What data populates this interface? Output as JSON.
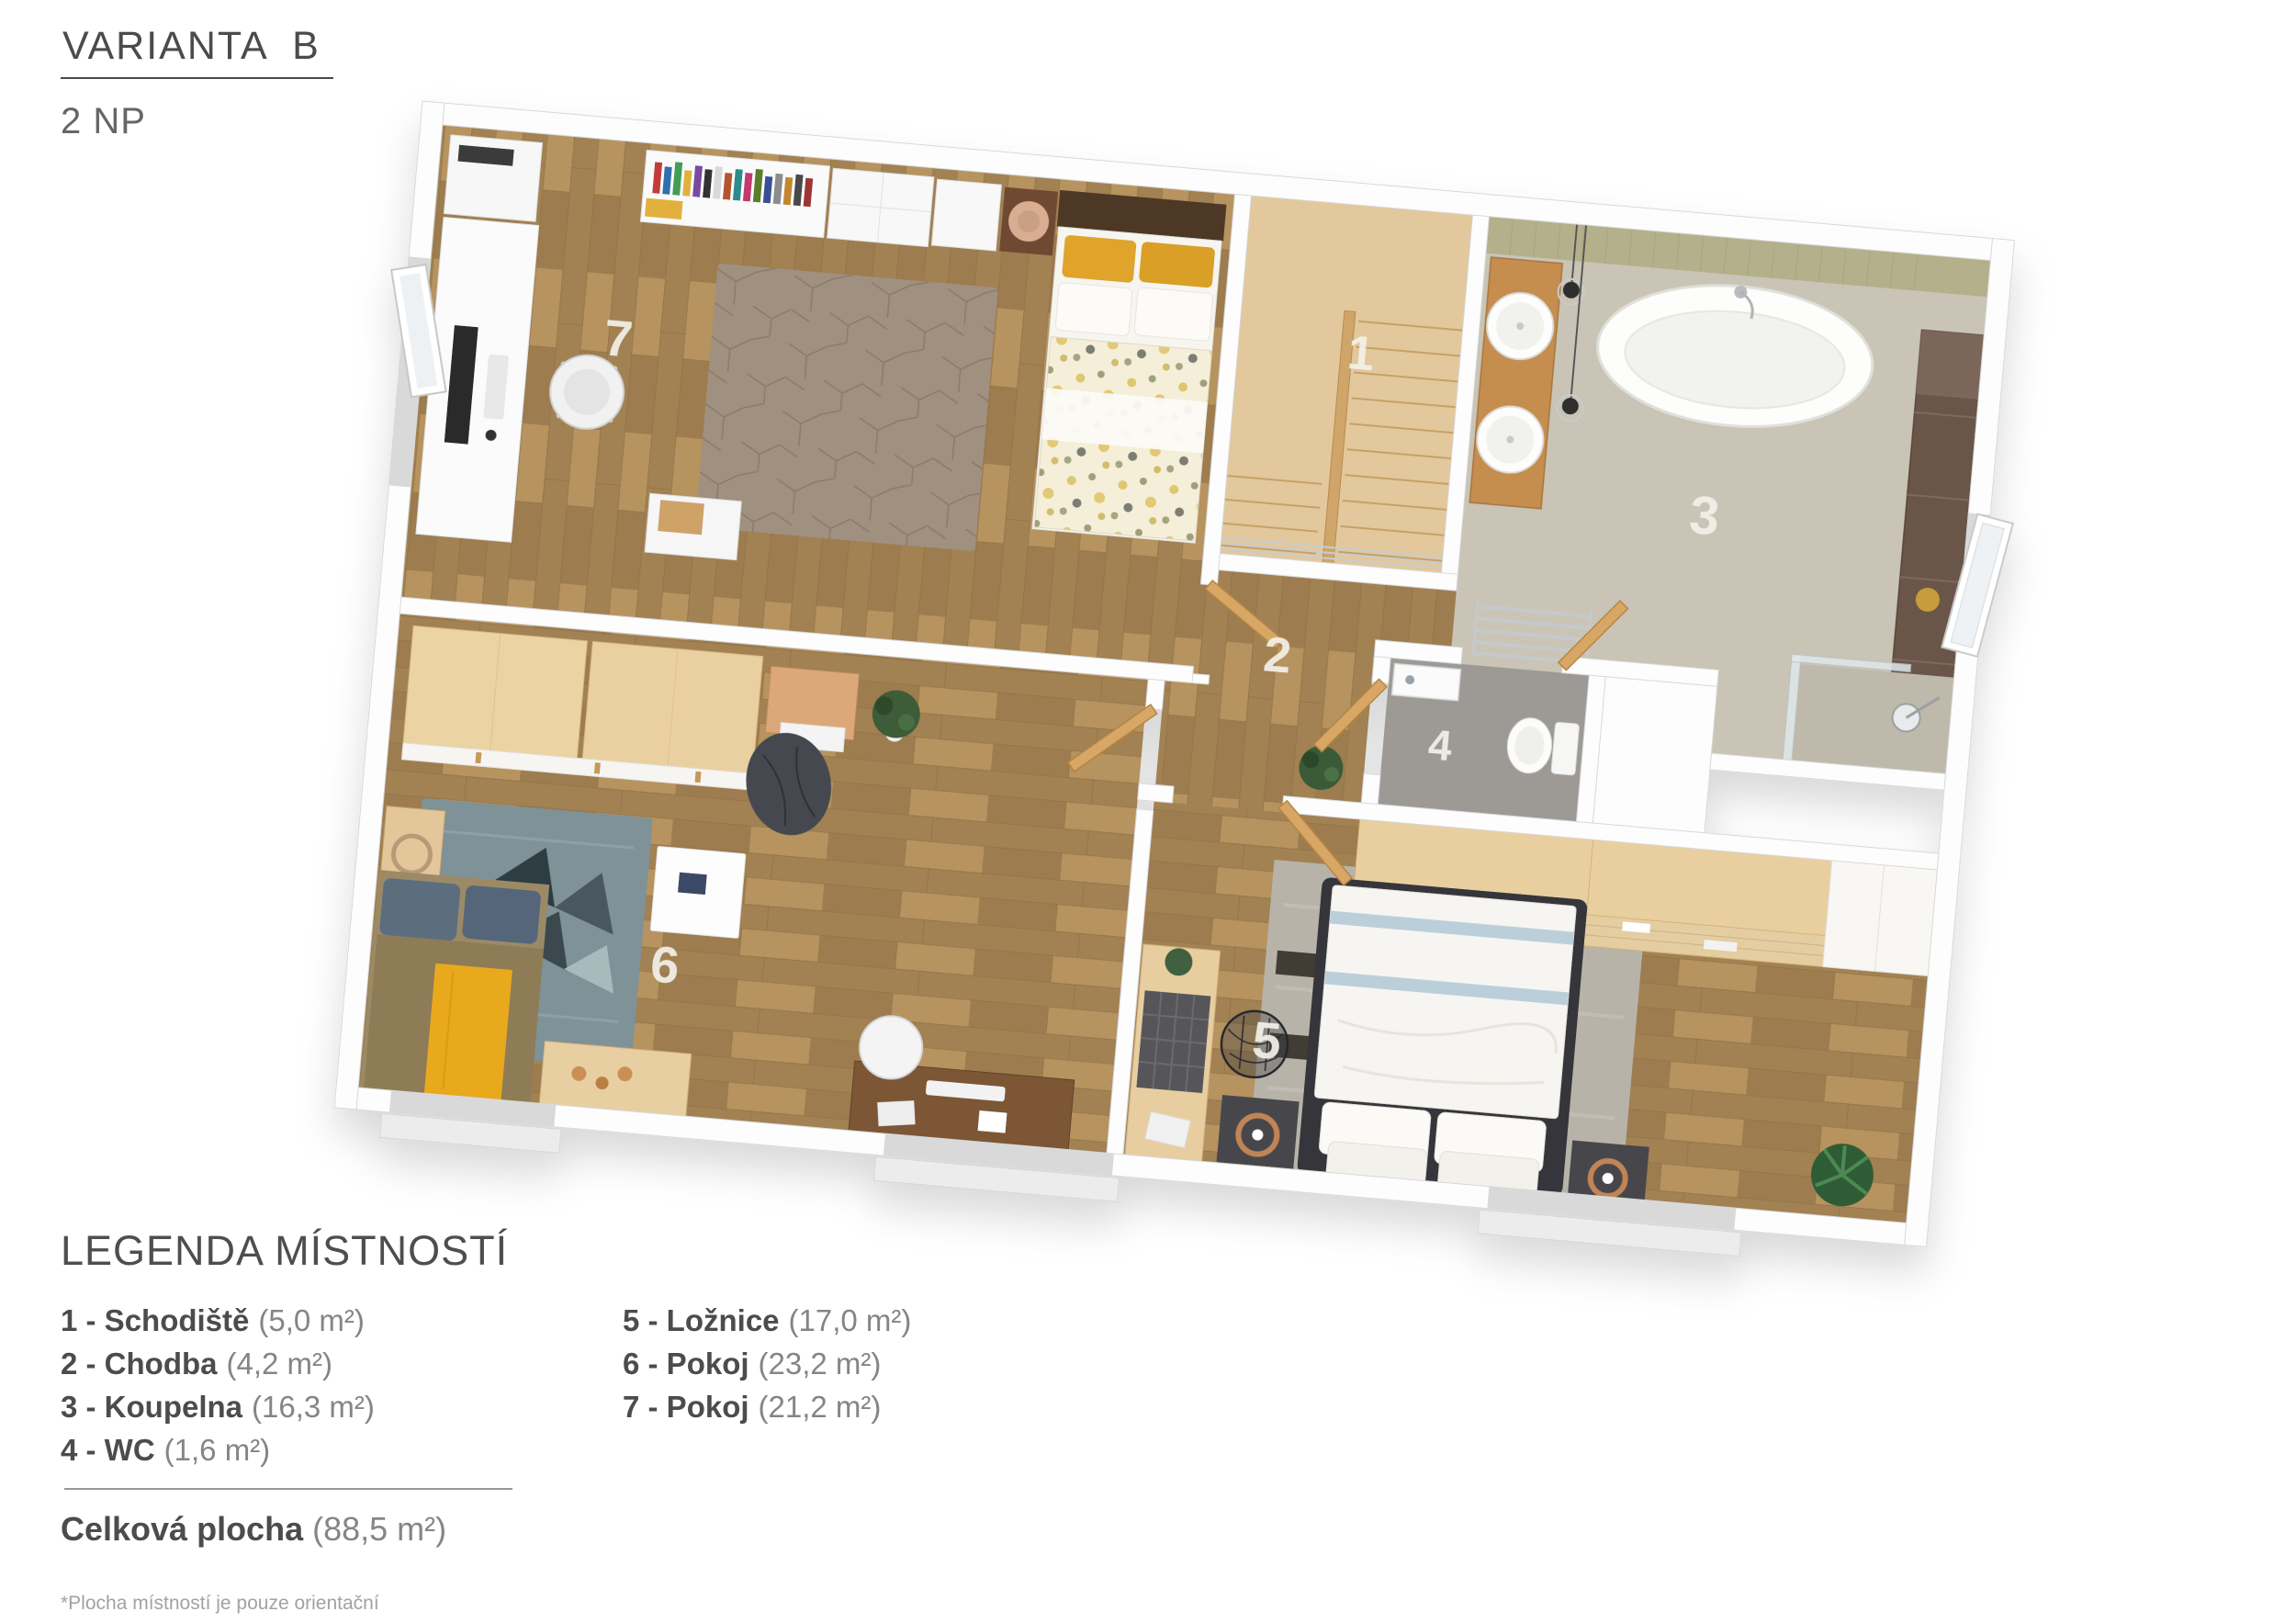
{
  "header": {
    "title": "VARIANTA  B",
    "subtitle": "2 NP"
  },
  "legend": {
    "title": "LEGENDA MÍSTNOSTÍ",
    "items": [
      {
        "label": "1 - Schodiště",
        "area": "(5,0 m²)"
      },
      {
        "label": "2 - Chodba",
        "area": "(4,2 m²)"
      },
      {
        "label": "3 - Koupelna",
        "area": "(16,3 m²)"
      },
      {
        "label": "4 - WC",
        "area": "(1,6 m²)"
      },
      {
        "label": "5 - Ložnice",
        "area": "(17,0 m²)"
      },
      {
        "label": "6 - Pokoj",
        "area": "(23,2 m²)"
      },
      {
        "label": "7 - Pokoj",
        "area": "(21,2 m²)"
      }
    ],
    "total_label": "Celková plocha",
    "total_area": "(88,5 m²)",
    "footnote": "*Plocha místností je pouze orientační"
  },
  "plan": {
    "room_numbers": {
      "r1": "1",
      "r2": "2",
      "r3": "3",
      "r4": "4",
      "r5": "5",
      "r6": "6",
      "r7": "7"
    },
    "colors": {
      "floor_wood": "#ac8b5e",
      "floor_stairs": "#e2c89c",
      "floor_bath": "#c9c4b5",
      "floor_wc": "#9d9a96",
      "tile_strip": "#b3b08b",
      "wardrobe_wood": "#ecd3a4",
      "cabinet_brown": "#6b574a",
      "rug_room7": "#a09080",
      "rug_teal": "#7e9298",
      "rug_gray": "#b8b3a9",
      "accent_yellow": "#e8a81e",
      "pillow_blue": "#5c6e7e",
      "duvet_blue": "#b5cbd8",
      "beanbag": "#45494f",
      "wall": "#fdfdfd"
    }
  }
}
